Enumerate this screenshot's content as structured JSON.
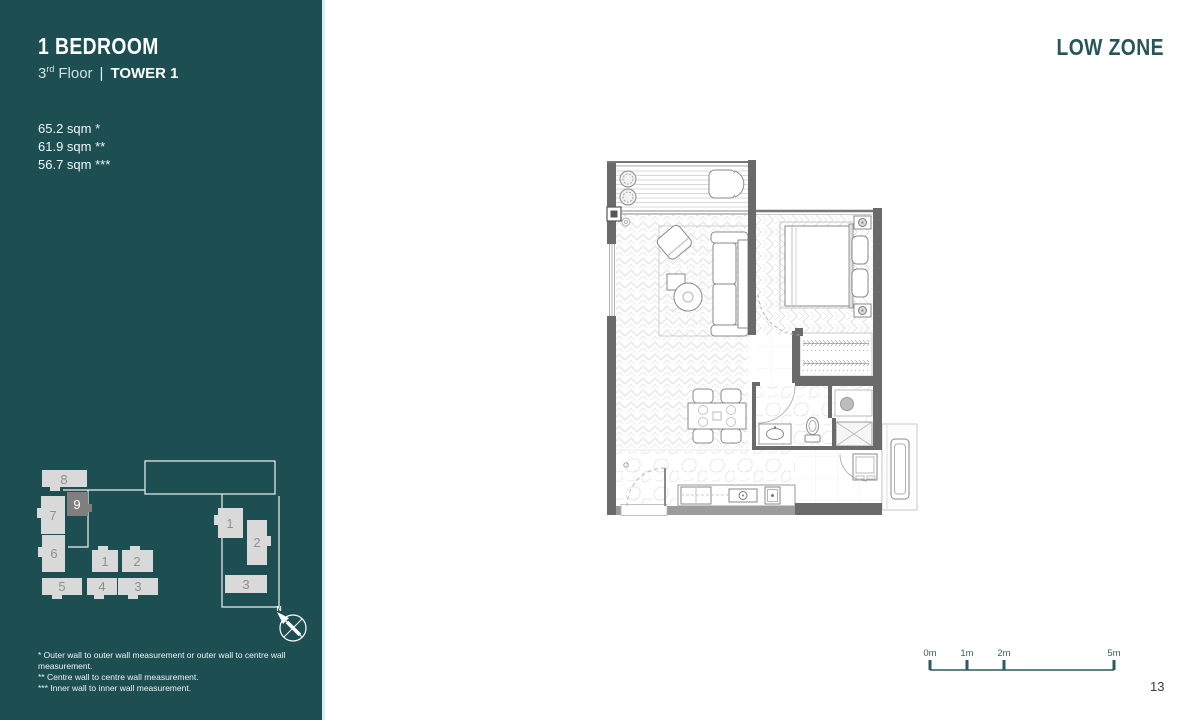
{
  "sidebar": {
    "title": "1 BEDROOM",
    "subtitle": {
      "floor_number": "3",
      "floor_ordinal": "rd",
      "floor_word": "Floor",
      "divider": "|",
      "tower": "TOWER 1"
    },
    "areas": [
      "65.2 sqm *",
      "61.9 sqm **",
      "56.7 sqm ***"
    ],
    "site_plan": {
      "left_buildings": [
        "8",
        "9",
        "7",
        "6",
        "1",
        "2",
        "5",
        "4",
        "3"
      ],
      "right_buildings": [
        "1",
        "2",
        "3"
      ],
      "highlighted_building": "9",
      "compass_label": "N"
    },
    "footnotes": [
      "* Outer wall to outer wall measurement or outer wall to centre wall measurement.",
      "** Centre wall to centre wall measurement.",
      "*** Inner wall to inner wall measurement."
    ]
  },
  "main": {
    "zone_label": "LOW ZONE",
    "page_number": "13",
    "scale_bar": {
      "labels": [
        "0m",
        "1m",
        "2m",
        "5m"
      ]
    }
  },
  "colors": {
    "sidebar_bg": "#1c4e52",
    "accent_teal": "#27565a",
    "building_fill": "#d9d9d9",
    "building_highlight": "#7f7f7f",
    "building_label": "#8f8f8f",
    "wall_dark": "#6a6a6a",
    "wall_light": "#9c9c9c"
  }
}
